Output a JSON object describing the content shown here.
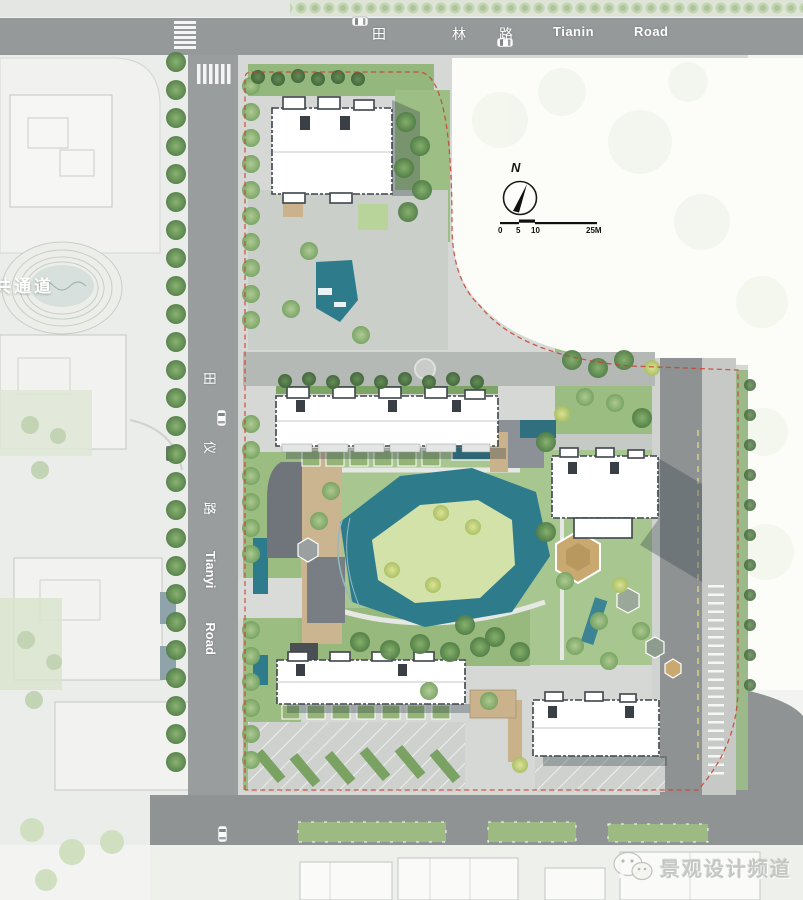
{
  "roads": {
    "tianlin": {
      "cn": [
        "田",
        "林",
        "路"
      ],
      "en": [
        "Tianin",
        "Road"
      ]
    },
    "tianyi": {
      "cn": [
        "田",
        "仪",
        "路"
      ],
      "en": [
        "Tianyi",
        "Road"
      ]
    }
  },
  "labels": {
    "public_passage": "共通道"
  },
  "compass": {
    "north": "N"
  },
  "scale_bar": {
    "ticks": [
      "0",
      "5",
      "10",
      "25M"
    ]
  },
  "watermark": {
    "icon": "wechat-icon",
    "text": "景观设计频道"
  },
  "colors": {
    "road_gray": "#96999a",
    "water_teal": "#2e7b8c",
    "lawn_green": "#a8c790",
    "boundary_red": "#c8432f",
    "deck_tan": "#c9b28c",
    "building_white": "#ffffff"
  }
}
